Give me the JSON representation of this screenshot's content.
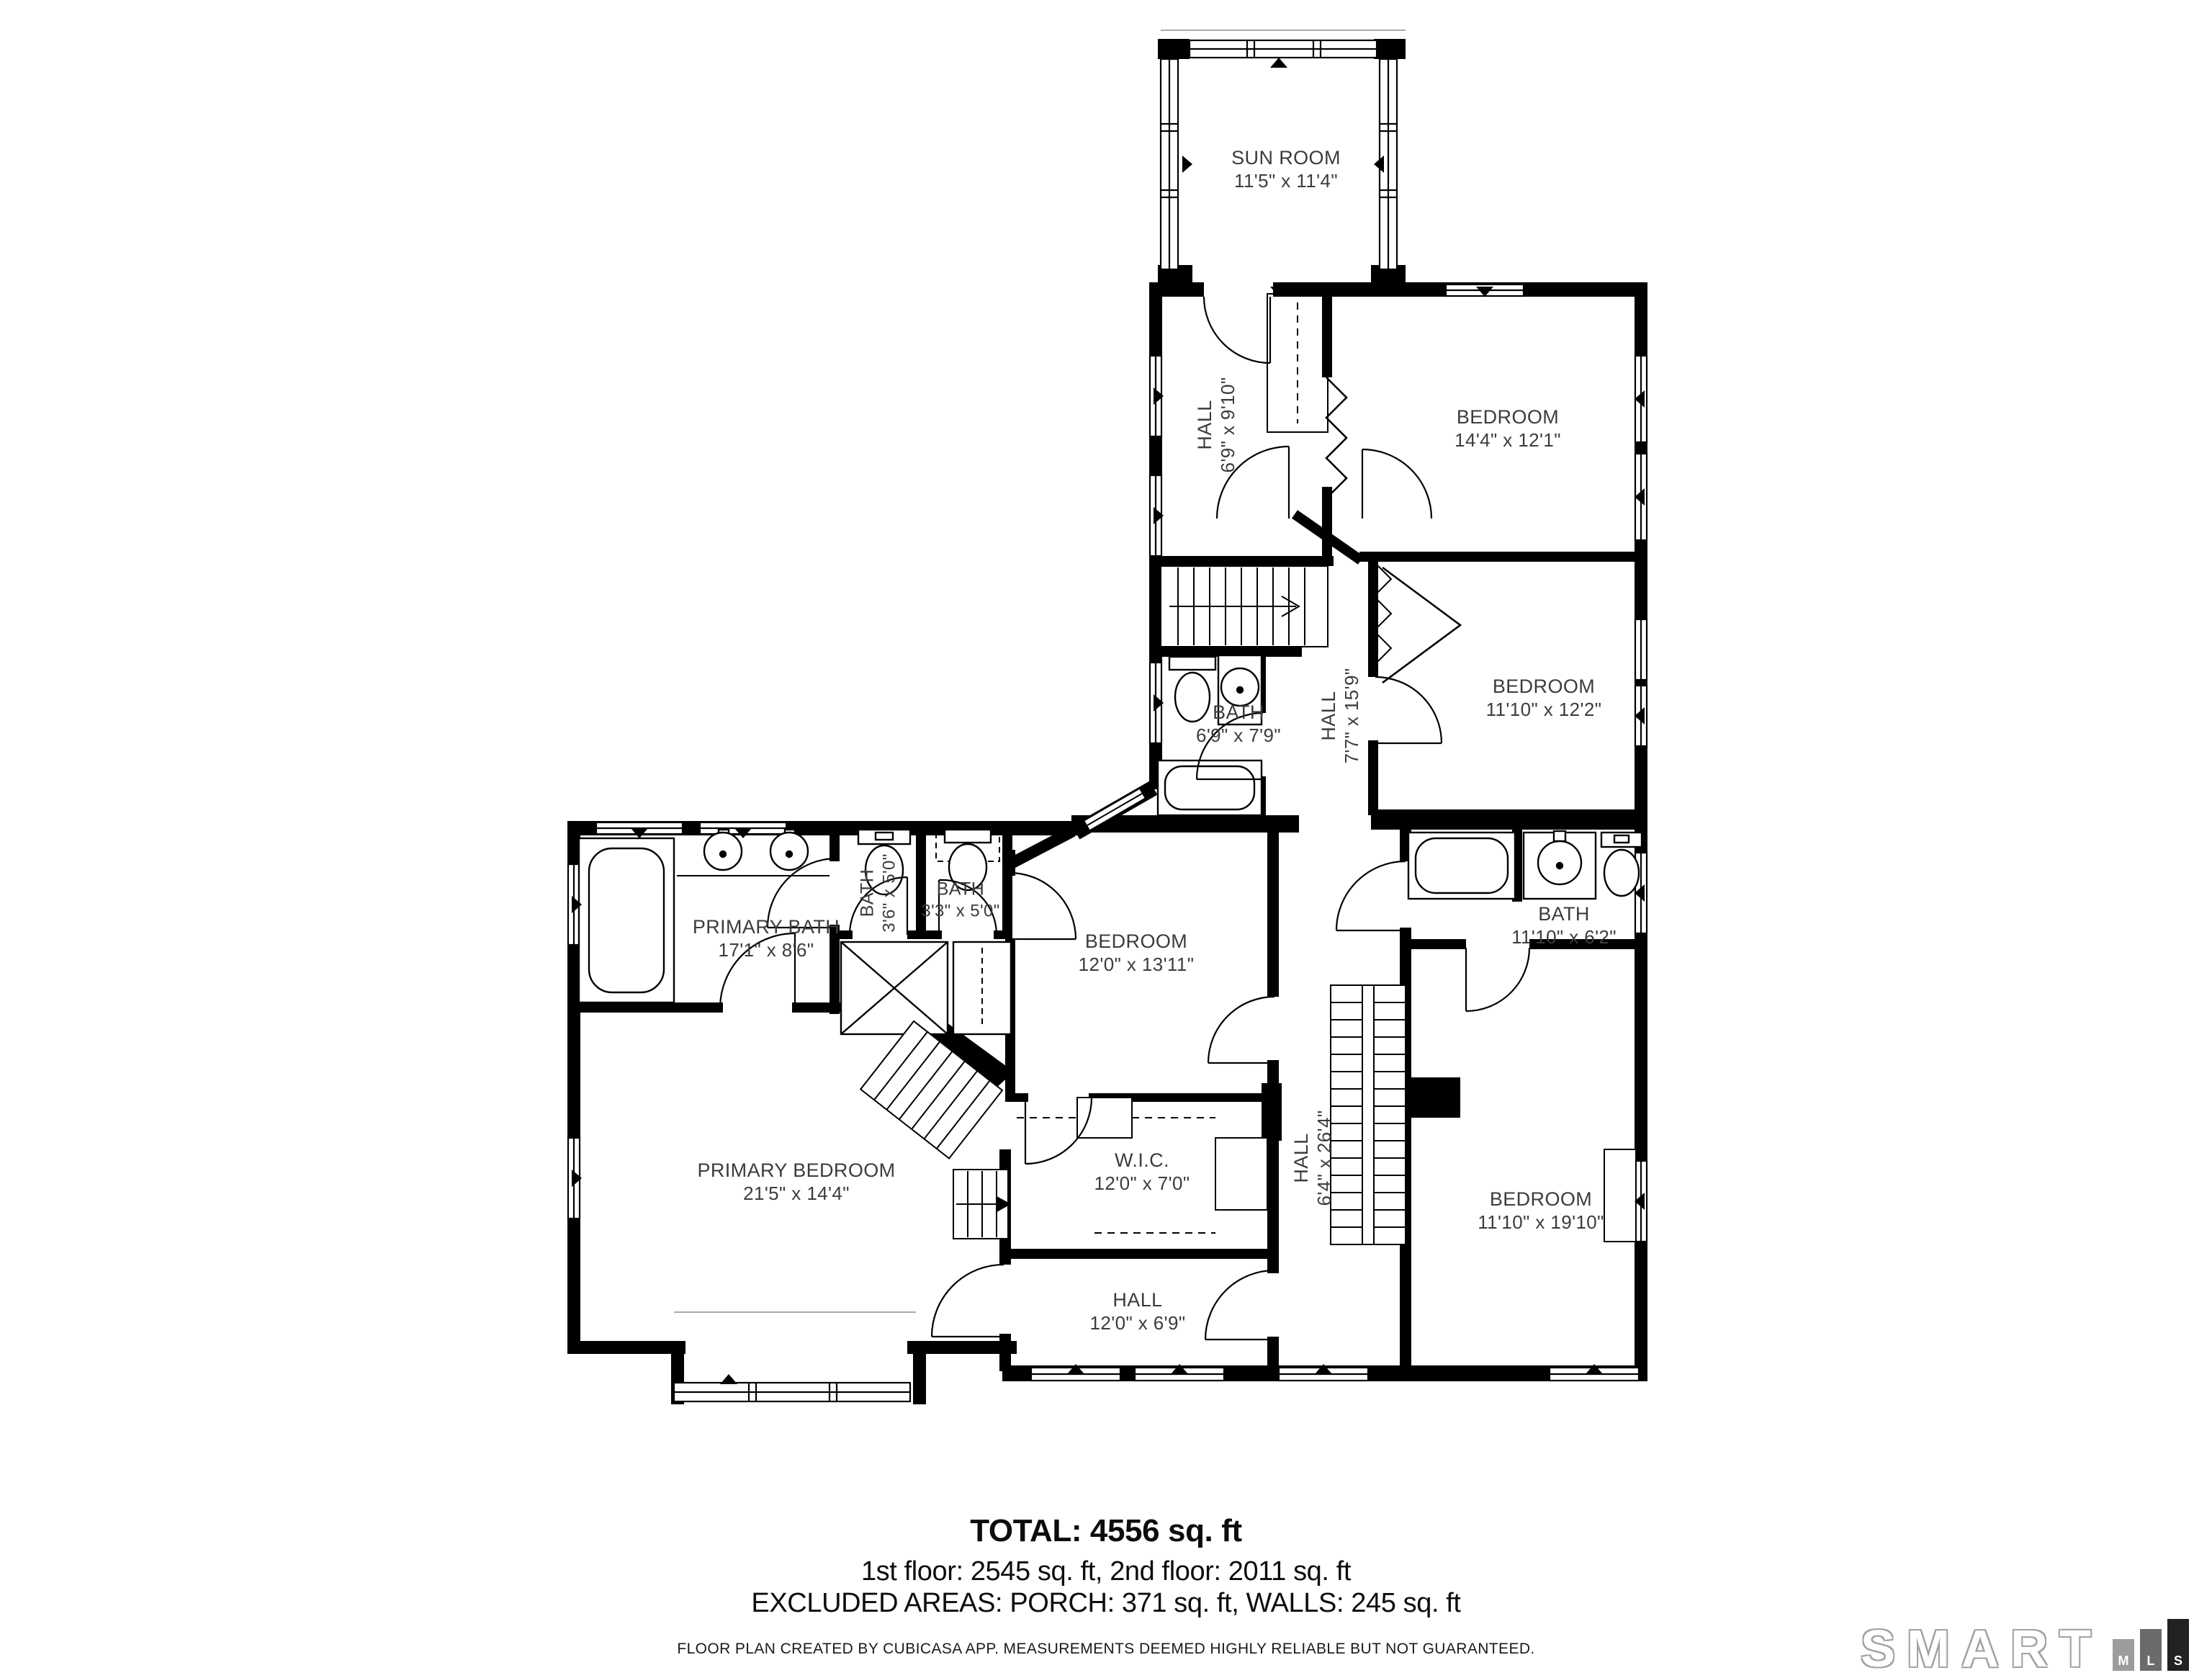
{
  "rooms": {
    "sun_room": {
      "name": "SUN ROOM",
      "dims": "11'5\" x 11'4\""
    },
    "hall_upper": {
      "name": "HALL",
      "dims": "6'9\" x 9'10\""
    },
    "bedroom_1": {
      "name": "BEDROOM",
      "dims": "14'4\" x 12'1\""
    },
    "bedroom_2": {
      "name": "BEDROOM",
      "dims": "11'10\" x 12'2\""
    },
    "bath_upper": {
      "name": "BATH",
      "dims": "6'9\" x 7'9\""
    },
    "hall_mid": {
      "name": "HALL",
      "dims": "7'7\" x 15'9\""
    },
    "primary_bath": {
      "name": "PRIMARY BATH",
      "dims": "17'1\" x 8'6\""
    },
    "bath_small_1": {
      "name": "BATH",
      "dims": "3'6\" x 5'0\""
    },
    "bath_small_2": {
      "name": "BATH",
      "dims": "3'3\" x 5'0\""
    },
    "bedroom_3": {
      "name": "BEDROOM",
      "dims": "12'0\" x 13'11\""
    },
    "bath_3": {
      "name": "BATH",
      "dims": "11'10\" x 6'2\""
    },
    "primary_bedroom": {
      "name": "PRIMARY BEDROOM",
      "dims": "21'5\" x 14'4\""
    },
    "wic": {
      "name": "W.I.C.",
      "dims": "12'0\" x 7'0\""
    },
    "hall_lower": {
      "name": "HALL",
      "dims": "6'4\" x 26'4\""
    },
    "bedroom_4": {
      "name": "BEDROOM",
      "dims": "11'10\" x 19'10\""
    },
    "hall_bottom": {
      "name": "HALL",
      "dims": "12'0\" x 6'9\""
    }
  },
  "title_block": {
    "total": "TOTAL: 4556 sq. ft",
    "floors": "1st floor: 2545 sq. ft, 2nd floor: 2011 sq. ft",
    "excluded": "EXCLUDED AREAS: PORCH: 371 sq. ft, WALLS: 245 sq. ft",
    "disclaimer": "FLOOR PLAN CREATED BY CUBICASA APP. MEASUREMENTS DEEMED HIGHLY RELIABLE BUT NOT GUARANTEED."
  },
  "logo": {
    "brand": "SMART",
    "m": "M",
    "l": "L",
    "s": "S"
  },
  "colors": {
    "wall": "#000000",
    "label": "#3c3c3c",
    "logo_gray": "#9c9c9c",
    "logo_mid": "#6b6b6b",
    "logo_dark": "#222222"
  }
}
